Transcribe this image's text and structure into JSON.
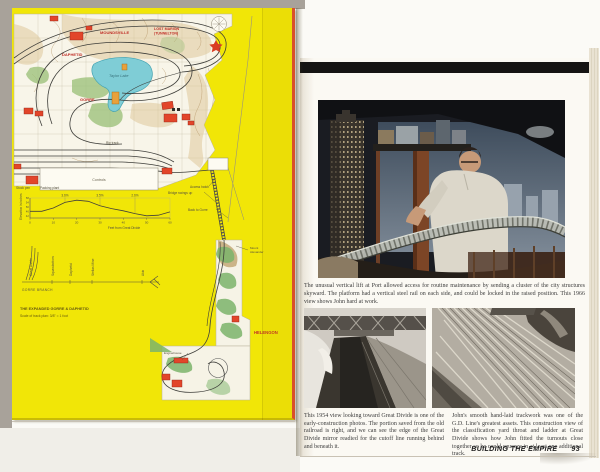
{
  "left_page": {
    "map_labels": {
      "town_top_left": "MOUNDSVILLE",
      "town_top_right_1": "LOST MARION",
      "town_top_right_2": "(TUNNELTON)",
      "daphetid": "DAPHETID",
      "gorre": "GORRE",
      "lake": "Taylor Lake",
      "rip_track": "Rip track",
      "controls": "Controls",
      "stock_pen": "Stock pen",
      "packing_plant": "Packing plant",
      "access_hatch": "Access hatch",
      "bridge_swings_up": "Bridge swings up",
      "back_to_gorre": "Back to Gorre",
      "helengon": "HELENGON",
      "mount_line1": "Mount",
      "mount_line2": "Alexander",
      "enginehouse": "Enginehouse"
    },
    "schematic": {
      "stations": [
        "Great Divide",
        "Squawbottom",
        "Daphetid",
        "Stellas Mine",
        "Akin"
      ],
      "line_label": "GORRE BRANCH"
    },
    "title": "THE EXPANDED GORRE & DAPHETID",
    "scale_note": "Scale of track plan: 3/8\" = 1 foot"
  },
  "right_page": {
    "caption_main": "The unusual vertical lift at Port allowed access for routine maintenance by sending a cluster of the city structures skyward. The platform had a vertical steel rail on each side, and could be locked in the raised position. This 1966 view shows John hard at work.",
    "caption_left": "This 1954 view looking toward Great Divide is one of the early-construction photos. The portion saved from the old railroad is right, and we can see the edge of the Great Divide mirror readied for the cutoff line running behind and beneath it.",
    "caption_right": "John's smooth hand-laid trackwork was one of the G.D. Line's greatest assets. This construction view of the classification yard throat and ladder at Great Divide shows how John fitted the turnouts close together so he could squeeze in at least one additional track.",
    "footer_title": "BUILDING THE EMPIRE",
    "page_number": "93"
  },
  "chart_data": {
    "type": "line",
    "xlabel": "Feet from Great Divide",
    "ylabel": "Elevation in inches",
    "x": [
      0,
      5,
      10,
      15,
      20,
      25,
      30,
      35,
      40,
      45,
      50,
      55,
      60
    ],
    "values": [
      46,
      46,
      49,
      54,
      56,
      55,
      51,
      48.5,
      46.5,
      44,
      42,
      42.5,
      45.5
    ],
    "x_ticks": [
      0,
      10,
      20,
      30,
      40,
      50,
      60
    ],
    "y_ticks": [
      42,
      46,
      50,
      54,
      58
    ],
    "xlim": [
      0,
      60
    ],
    "ylim": [
      40,
      58
    ],
    "annotations": [
      "3.6%",
      "3.5%",
      "2.6%"
    ],
    "annotation_x": [
      15,
      30,
      45
    ],
    "grid": false,
    "legend": "none"
  }
}
